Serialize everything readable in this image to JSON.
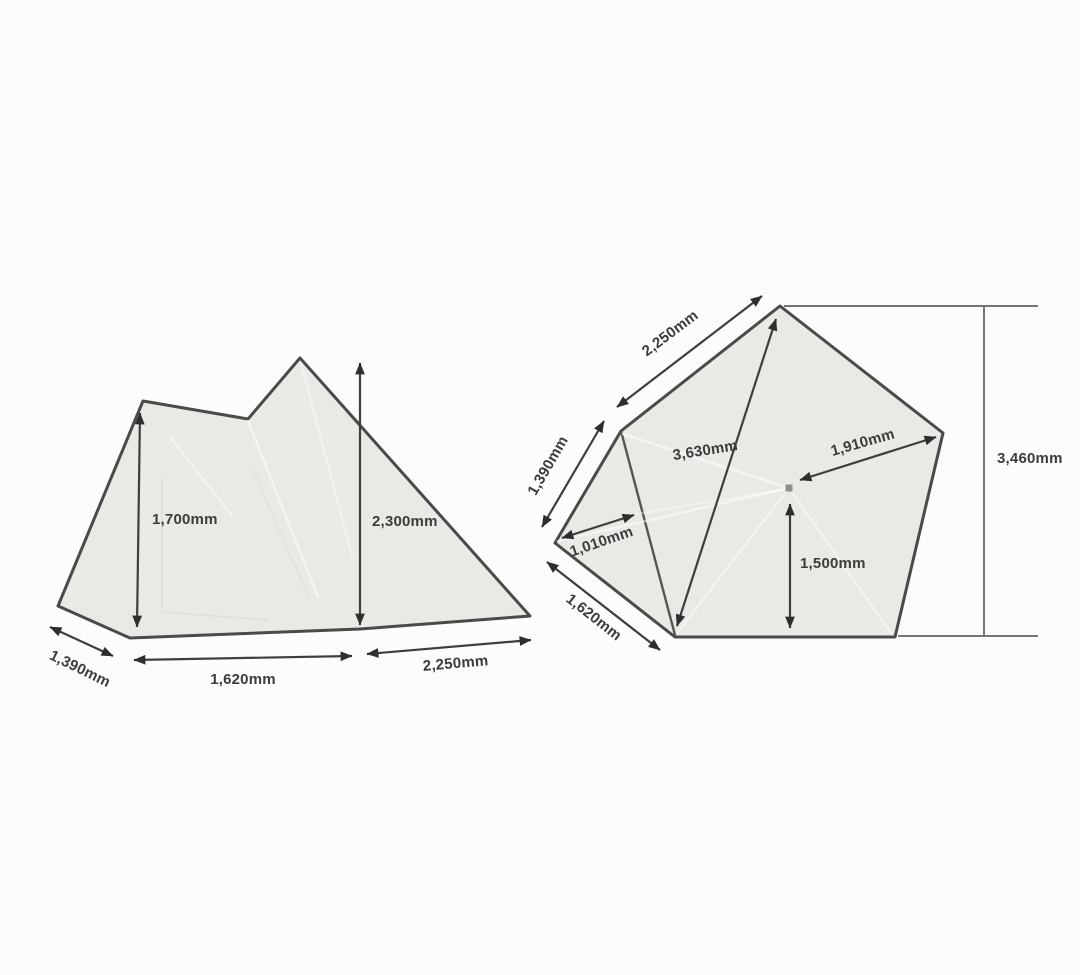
{
  "diagram": {
    "subject": "tent-dimension-diagram",
    "unit": "mm",
    "colors": {
      "background": "#fcfcfc",
      "panel_fill": "#e9e9e5",
      "outline": "#4a4a4a",
      "dimension": "#3e3e3e"
    },
    "side_view": {
      "height_inner": "1,700mm",
      "height_peak": "2,300mm",
      "width_front": "1,390mm",
      "width_floor": "1,620mm",
      "width_rear": "2,250mm"
    },
    "floor_plan": {
      "edge_top_left": "2,250mm",
      "edge_left": "1,390mm",
      "diagonal_long": "3,630mm",
      "center_to_right": "1,910mm",
      "inner_left": "1,010mm",
      "center_to_bottom": "1,500mm",
      "edge_bottom_left": "1,620mm",
      "overall_width": "3,460mm"
    }
  }
}
